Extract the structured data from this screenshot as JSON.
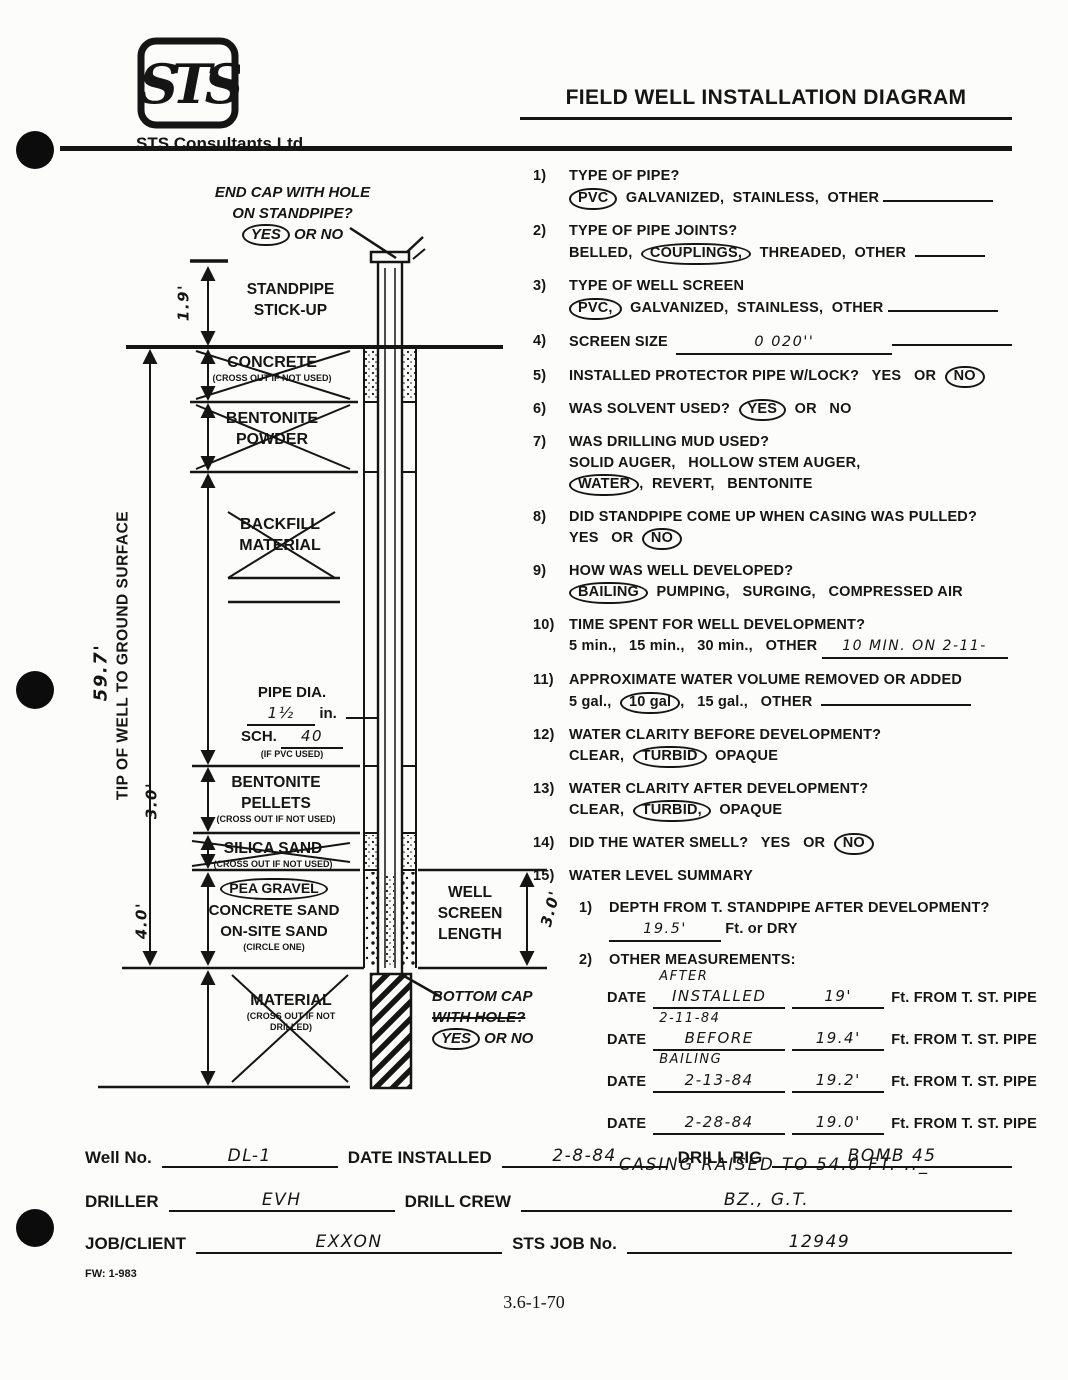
{
  "colors": {
    "ink": "#151515",
    "paper": "#fcfcfa"
  },
  "header": {
    "logo_text": "STS",
    "company": "STS Consultants Ltd.",
    "title": "FIELD WELL INSTALLATION DIAGRAM"
  },
  "diagram": {
    "end_cap": {
      "line1": "END CAP WITH HOLE",
      "line2": "ON STANDPIPE?",
      "yes": "YES",
      "or_no": " OR NO"
    },
    "stickup": {
      "line1": "STANDPIPE",
      "line2": "STICK-UP",
      "dim": "1.9'"
    },
    "concrete": {
      "name": "CONCRETE",
      "note": "(CROSS OUT IF NOT USED)"
    },
    "bentonite_powder": {
      "line1": "BENTONITE",
      "line2": "POWDER"
    },
    "backfill": {
      "line1": "BACKFILL",
      "line2": "MATERIAL"
    },
    "pipe": {
      "dia_label": "PIPE DIA.",
      "dia_value": "1½",
      "dia_unit": " in.",
      "sch_label": "SCH. ",
      "sch_value": "40",
      "note": "(IF PVC USED)"
    },
    "pellets": {
      "line1": "BENTONITE",
      "line2": "PELLETS",
      "note": "(CROSS OUT IF NOT USED)",
      "dim": "3.0'"
    },
    "silica": {
      "name": "SILICA SAND",
      "note": "(CROSS OUT IF NOT USED)"
    },
    "gravel": {
      "opt1": "PEA GRAVEL",
      "opt2": "CONCRETE SAND",
      "opt3": "ON-SITE SAND",
      "note": "(CIRCLE ONE)",
      "dim": "4.0'"
    },
    "material": {
      "name": "MATERIAL",
      "note1": "(CROSS OUT IF NOT",
      "note2": "DRILLED)"
    },
    "tip": {
      "label": "TIP OF WELL TO GROUND SURFACE",
      "dim": "59.7'"
    },
    "screen": {
      "line1": "WELL",
      "line2": "SCREEN",
      "line3": "LENGTH",
      "dim": "3.0'"
    },
    "bottom_cap": {
      "line1": "BOTTOM CAP",
      "line2": "WITH HOLE?",
      "yes": "YES",
      "or_no": " OR NO"
    }
  },
  "questions": [
    {
      "num": "1)",
      "title": "TYPE OF PIPE?",
      "circled": "PVC",
      "rest": "GALVANIZED,  STAINLESS,  OTHER"
    },
    {
      "num": "2)",
      "title": "TYPE OF PIPE JOINTS?",
      "pre": "BELLED,",
      "circled": "COUPLINGS,",
      "rest": "THREADED,  OTHER"
    },
    {
      "num": "3)",
      "title": "TYPE OF WELL SCREEN",
      "circled": "PVC,",
      "rest": "GALVANIZED,  STAINLESS,  OTHER"
    },
    {
      "num": "4)",
      "label": "SCREEN SIZE",
      "value": "0 020''"
    },
    {
      "num": "5)",
      "label": "INSTALLED PROTECTOR PIPE W/LOCK?",
      "pre": "YES   OR",
      "circled": "NO"
    },
    {
      "num": "6)",
      "label": "WAS SOLVENT USED?",
      "circled": "YES",
      "rest": "OR   NO"
    },
    {
      "num": "7)",
      "title": "WAS DRILLING MUD USED?",
      "line2": "SOLID AUGER,   HOLLOW STEM AUGER,",
      "circled": "WATER",
      "rest": ",  REVERT,   BENTONITE"
    },
    {
      "num": "8)",
      "title": "DID STANDPIPE COME UP WHEN CASING WAS PULLED?",
      "pre": "YES   OR",
      "circled": "NO"
    },
    {
      "num": "9)",
      "title": "HOW WAS WELL DEVELOPED?",
      "circled": "BAILING",
      "rest": "PUMPING,   SURGING,   COMPRESSED AIR"
    },
    {
      "num": "10)",
      "title": "TIME SPENT FOR WELL DEVELOPMENT?",
      "pre": "5 min.,   15 min.,   30 min.,   OTHER",
      "value": "10 MIN. ON 2-11-"
    },
    {
      "num": "11)",
      "title": "APPROXIMATE WATER VOLUME REMOVED OR ADDED",
      "pre": "5 gal.,",
      "circled": "10 gal",
      "rest": ",   15 gal.,   OTHER"
    },
    {
      "num": "12)",
      "title": "WATER CLARITY BEFORE DEVELOPMENT?",
      "pre": "CLEAR,",
      "circled": "TURBID",
      "rest": "OPAQUE"
    },
    {
      "num": "13)",
      "title": "WATER CLARITY AFTER DEVELOPMENT?",
      "pre": "CLEAR,",
      "circled": "TURBID,",
      "rest": "OPAQUE"
    },
    {
      "num": "14)",
      "label": "DID THE WATER SMELL?",
      "pre": "YES   OR",
      "circled": "NO"
    },
    {
      "num": "15)",
      "label": "WATER LEVEL SUMMARY"
    }
  ],
  "water_summary": {
    "item1": {
      "num": "1)",
      "question": "DEPTH FROM T. STANDPIPE AFTER DEVELOPMENT?",
      "value": "19.5'",
      "suffix": " Ft. or DRY"
    },
    "item2": {
      "num": "2)",
      "label": "OTHER MEASUREMENTS:"
    },
    "rows": [
      {
        "label": "DATE",
        "above": "AFTER",
        "main": "INSTALLED",
        "value": "19'",
        "suffix": "Ft. FROM T. ST. PIPE"
      },
      {
        "label": "DATE",
        "above": "2-11-84",
        "main": "BEFORE",
        "below": "BAILING",
        "value": "19.4'",
        "suffix": "Ft. FROM T. ST. PIPE"
      },
      {
        "label": "DATE",
        "main": "2-13-84",
        "value": "19.2'",
        "suffix": "Ft. FROM T. ST. PIPE"
      },
      {
        "label": "DATE",
        "main": "2-28-84",
        "value": "19.0'",
        "suffix": "Ft. FROM T. ST. PIPE"
      }
    ],
    "note": "CASING RAISED TO 54.0 FT. .._"
  },
  "footer": {
    "well_no_label": "Well No.",
    "well_no": "DL-1",
    "date_installed_label": "DATE INSTALLED",
    "date_installed": "2-8-84",
    "drill_rig_label": "DRILL RIG",
    "drill_rig": "BOMB 45",
    "driller_label": "DRILLER",
    "driller": "EVH",
    "drill_crew_label": "DRILL CREW",
    "drill_crew": "BZ., G.T.",
    "job_client_label": "JOB/CLIENT",
    "job_client": "EXXON",
    "sts_job_label": "STS JOB No.",
    "sts_job": "12949",
    "form_code": "FW: 1-983",
    "page_code": "3.6-1-70"
  }
}
